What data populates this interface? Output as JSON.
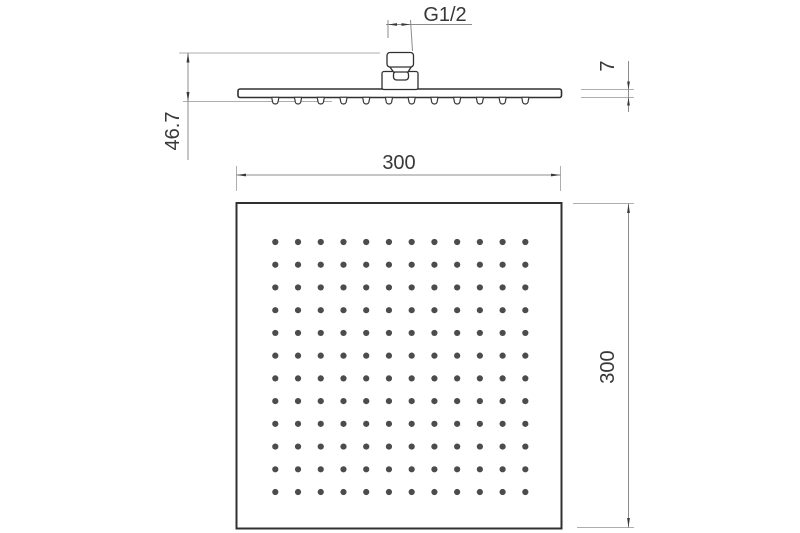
{
  "drawing": {
    "title": "square-shower-head-dimension-drawing",
    "labels": {
      "thread_size": "G1/2",
      "plate_thickness": "7",
      "total_height": "46.7",
      "width_top": "300",
      "height_right": "300"
    },
    "side_view": {
      "nozzle_count": 12
    },
    "bottom_view": {
      "grid_rows": 12,
      "grid_cols": 12
    },
    "colors": {
      "background": "#ffffff",
      "object_line": "#303030",
      "dimension_line": "#8c8c8c",
      "extension_line": "#aeaeae",
      "text": "#383838",
      "spray_hole": "#4c4c4c"
    }
  }
}
